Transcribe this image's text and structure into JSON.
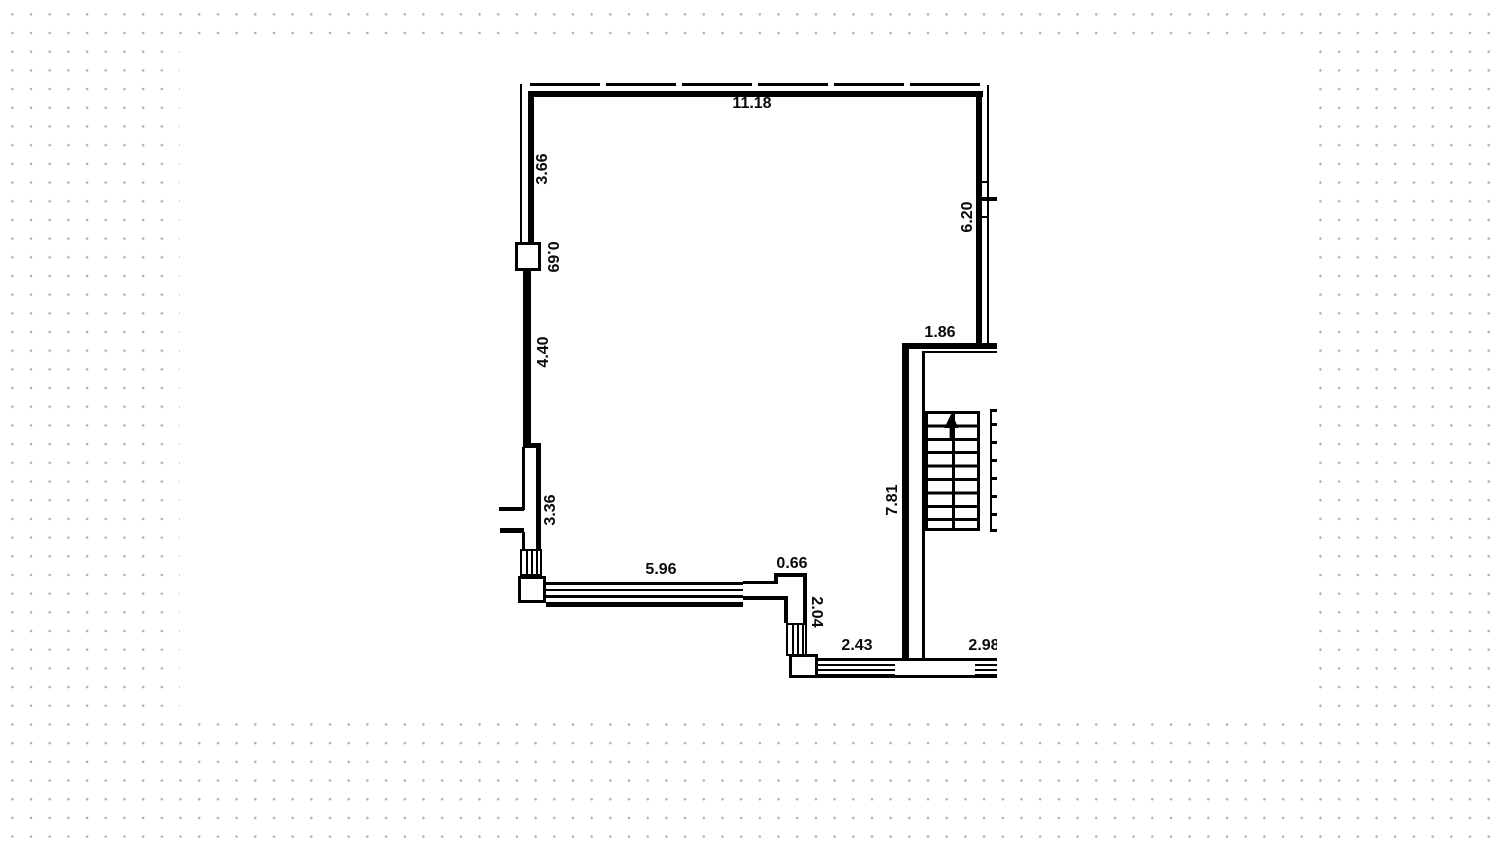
{
  "app": {
    "view": "floor-plan-drawing"
  },
  "floor_plan": {
    "units_note": "",
    "dimension_labels": {
      "top_wall": "11.18",
      "left_wall_upper": "3.66",
      "left_wall_pillar": "0.69",
      "left_wall_middle": "4.40",
      "left_wall_lower": "3.36",
      "right_wall": "6.20",
      "stair_landing": "1.86",
      "stair_wall": "7.81",
      "bottom_window_left": "5.96",
      "bottom_jog_width": "0.66",
      "bottom_jog_height": "2.04",
      "bottom_window_middle": "2.43",
      "bottom_window_right": "2.98"
    },
    "colors": {
      "wall": "#000000",
      "paper": "#ffffff",
      "dot_grid": "#b0b0b0"
    }
  }
}
